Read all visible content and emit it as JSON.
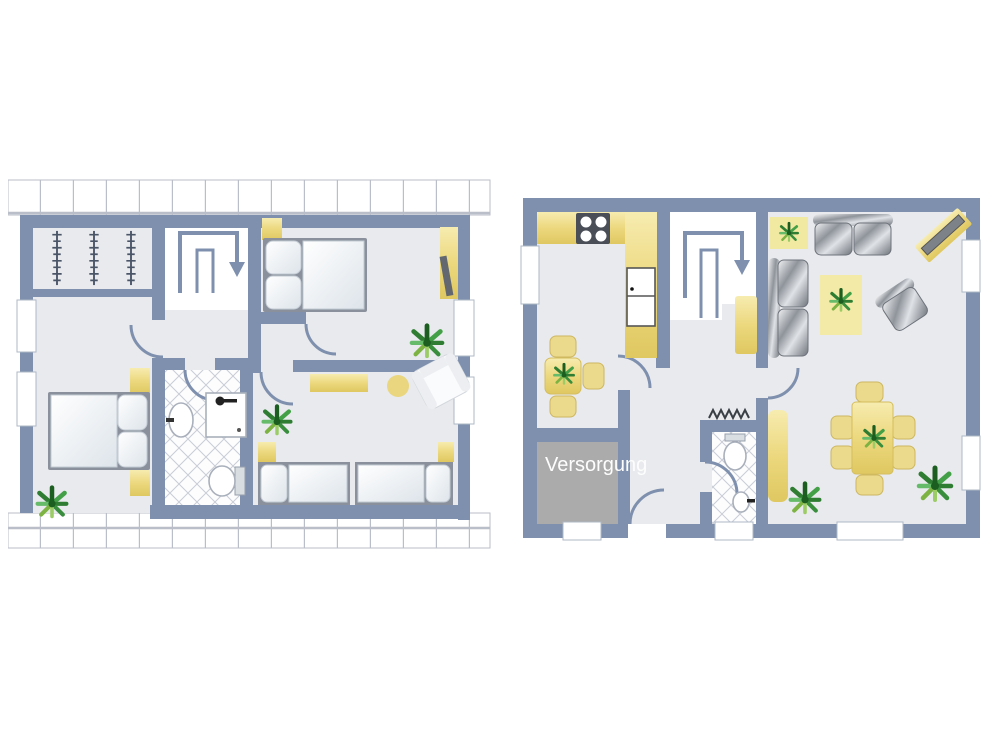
{
  "canvas": {
    "width": 1000,
    "height": 750,
    "background": "#FFFFFF"
  },
  "palette": {
    "wall_blue": "#7E90AE",
    "floor_gray": "#E8EAED",
    "stairwell_white": "#FFFFFF",
    "furniture_yellow": "#EDD87E",
    "utility_room_gray": "#ABABAB",
    "utility_label_text": "#FFFFFF",
    "sofa_silver": "#9CA1A8",
    "plant_green": "#2E7D32",
    "tile_line": "#C9CDD6",
    "roof_hatch_line": "#B9BEC8"
  },
  "upper_floor_plan": {
    "icons": [
      "roof-hatch-icon",
      "clothes-rack-icon",
      "stairs-down-arrow-icon",
      "double-bed-icon",
      "nightstand-icon",
      "desk-icon",
      "plant-icon",
      "door-arc-icon",
      "window-icon",
      "sink-icon",
      "shower-icon",
      "toilet-icon",
      "tile-floor-icon",
      "sideboard-icon",
      "stool-icon",
      "armchair-icon",
      "single-bed-icon"
    ]
  },
  "ground_floor_plan": {
    "utility_room_label": "Versorgung",
    "icons": [
      "kitchen-counter-icon",
      "stove-icon",
      "refrigerator-icon",
      "dining-table-icon",
      "chair-icon",
      "plant-icon",
      "stairs-down-arrow-icon",
      "wardrobe-icon",
      "door-arc-icon",
      "window-icon",
      "radiator-icon",
      "toilet-icon",
      "sink-icon",
      "tile-floor-icon",
      "sofa-icon",
      "tv-board-icon",
      "rug-icon",
      "armchair-icon",
      "cabinet-icon",
      "dining-set-icon"
    ]
  }
}
